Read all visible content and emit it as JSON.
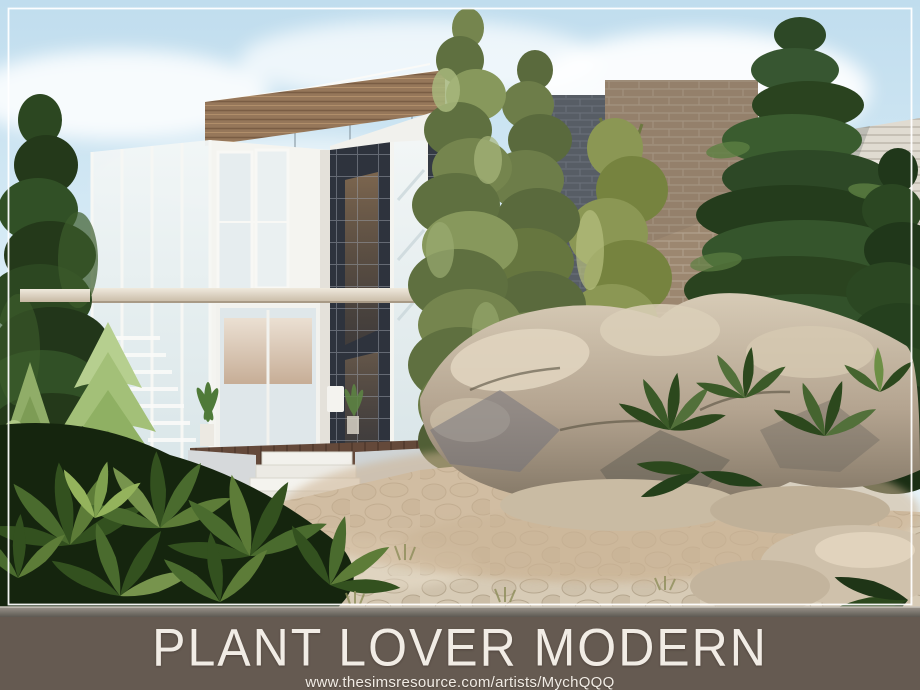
{
  "banner": {
    "title": "PLANT LOVER MODERN",
    "url": "www.thesimsresource.com/artists/MychQQQ",
    "background_color": "#655a51",
    "text_color": "#f1ece5"
  },
  "scene": {
    "palette": {
      "sky_top": "#c0ddee",
      "sky_bottom": "#f0f8fb",
      "cloud": "#ffffff",
      "foliage_dark": "#2c4721",
      "foliage_olive": "#75854e",
      "foliage_light": "#a3c078",
      "brick": "#a69078",
      "brick_dark": "#575d65",
      "wood_slats": "#96775a",
      "tile_dark": "#2e333d",
      "house_white": "#f4f4f0",
      "glass": "#e7eff1",
      "rock_light": "#d8ccb8",
      "rock_shadow": "#79705f",
      "path": "#d7cbb6",
      "ground_strip": "#5b5650",
      "frame_border": "#ffffff"
    },
    "objects": [
      "sky",
      "clouds",
      "modern-house",
      "glass-walls",
      "wood-slat-band",
      "dark-tile-wall",
      "entry-steps",
      "cypress-trees",
      "pine-trees",
      "spruce-trees",
      "ivy-climbers",
      "fern-bushes",
      "rock-garden",
      "cobblestone-path",
      "white-frame-border"
    ]
  }
}
